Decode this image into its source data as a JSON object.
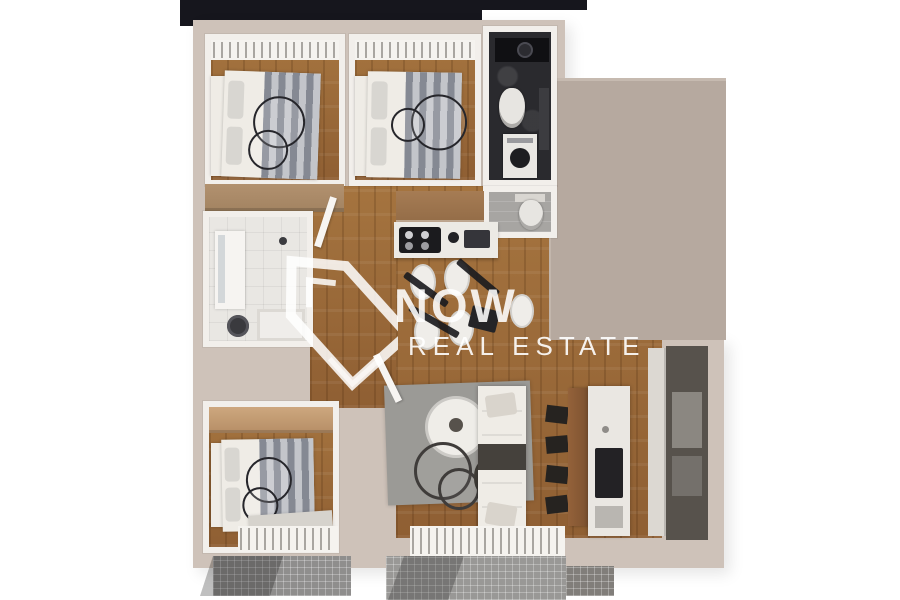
{
  "watermark": {
    "icon": "house-outline-icon",
    "title": "NOW",
    "subtitle": "REAL ESTATE"
  },
  "palette": {
    "background": "#ffffff",
    "outer_wall": "#cec2b9",
    "inner_wall": "#f2efeb",
    "roof_terrace": "#b6a99f",
    "wood_floor": "#9c6c3e",
    "dark_roof_band": "#16161d",
    "dark_bathroom": "#2a2a2e",
    "wc_floor": "#a7a5a2",
    "rug": "#9b9a96",
    "bar_wood": "#8a5a33",
    "kitchen_cabinet": "#9b734e",
    "tall_cabinets": "#57524c",
    "wardrobe_tan": "#c0996f",
    "balcony_tile": "#919090",
    "watermark_white": "#ffffff"
  }
}
